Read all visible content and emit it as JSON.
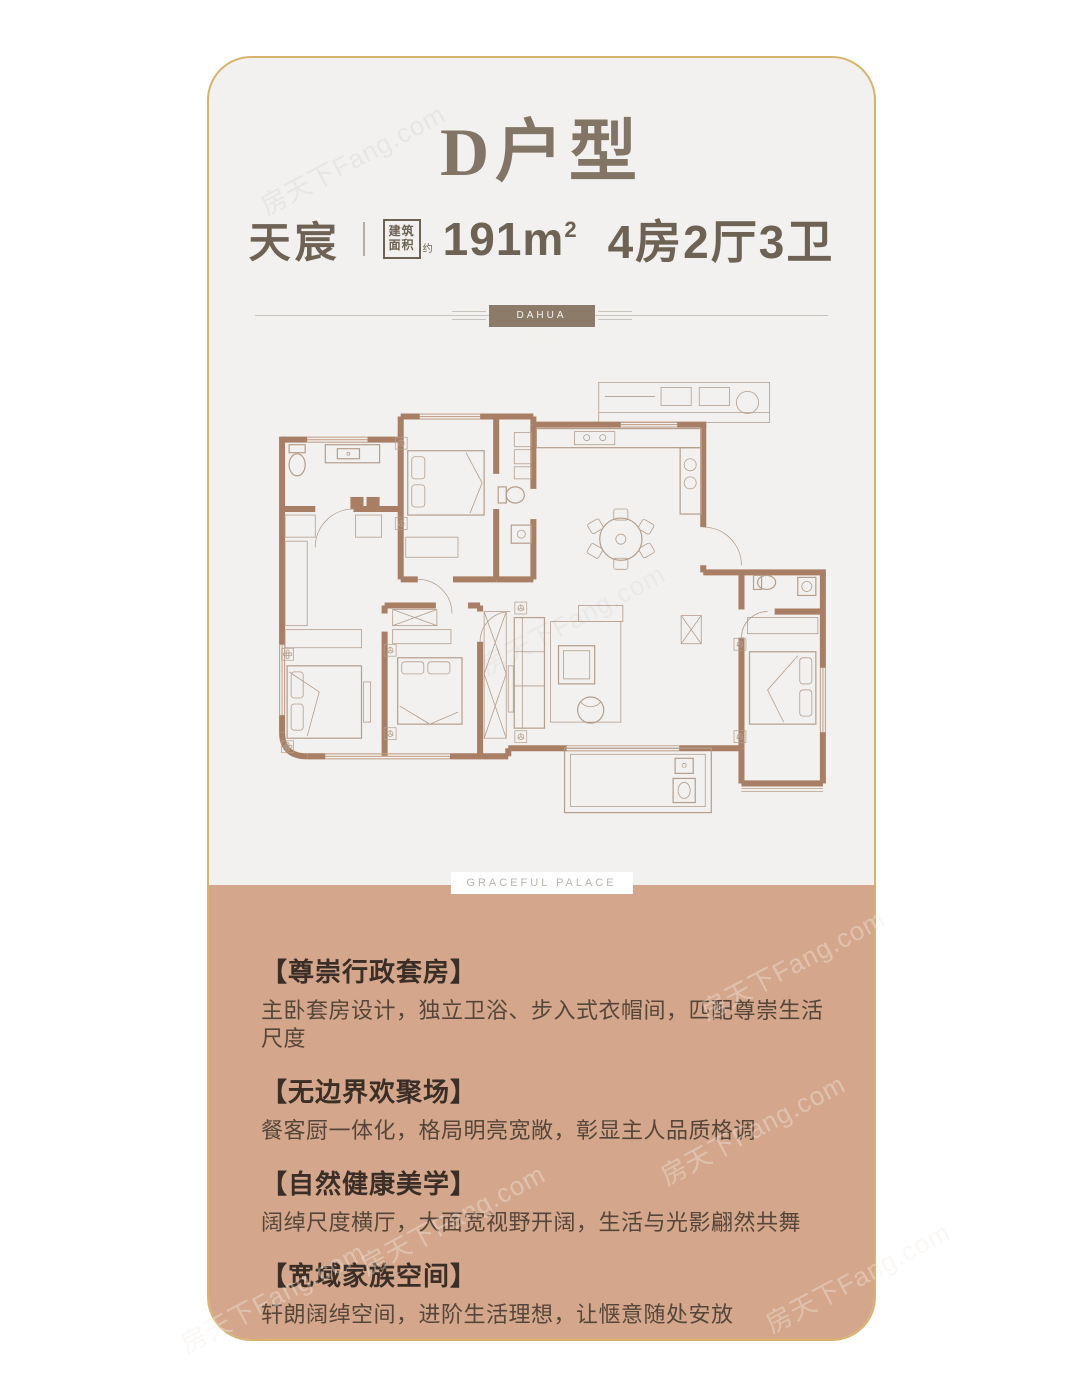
{
  "watermark": "房天下Fang.com",
  "colors": {
    "gold": "#d7b36e",
    "cardbg": "#f2f1ef",
    "tan": "#d4a78c",
    "title": "#827566",
    "subtitle": "#6d6253",
    "badge": "#8b7b68",
    "wall": "#a87f64",
    "furn": "#b59e8d",
    "heading": "#3a2e26",
    "body": "#564639"
  },
  "card": {
    "title": "D户型",
    "subtitle": {
      "project": "天宸",
      "area_label_top": "建筑",
      "area_label_bottom": "面积",
      "area_approx": "约",
      "area_number": "191m",
      "area_sup": "2",
      "rooms": "4房2厅3卫"
    },
    "divider": {
      "badge": "DAHUA GROUP"
    },
    "plan": {
      "caption": "GRACEFUL PALACE"
    },
    "features": [
      {
        "heading": "【尊崇行政套房】",
        "body": "主卧套房设计，独立卫浴、步入式衣帽间，匹配尊崇生活尺度"
      },
      {
        "heading": "【无边界欢聚场】",
        "body": "餐客厨一体化，格局明亮宽敞，彰显主人品质格调"
      },
      {
        "heading": "【自然健康美学】",
        "body": "阔绰尺度横厅，大面宽视野开阔，生活与光影翩然共舞"
      },
      {
        "heading": "【宽域家族空间】",
        "body": "轩朗阔绰空间，进阶生活理想，让惬意随处安放"
      }
    ]
  }
}
